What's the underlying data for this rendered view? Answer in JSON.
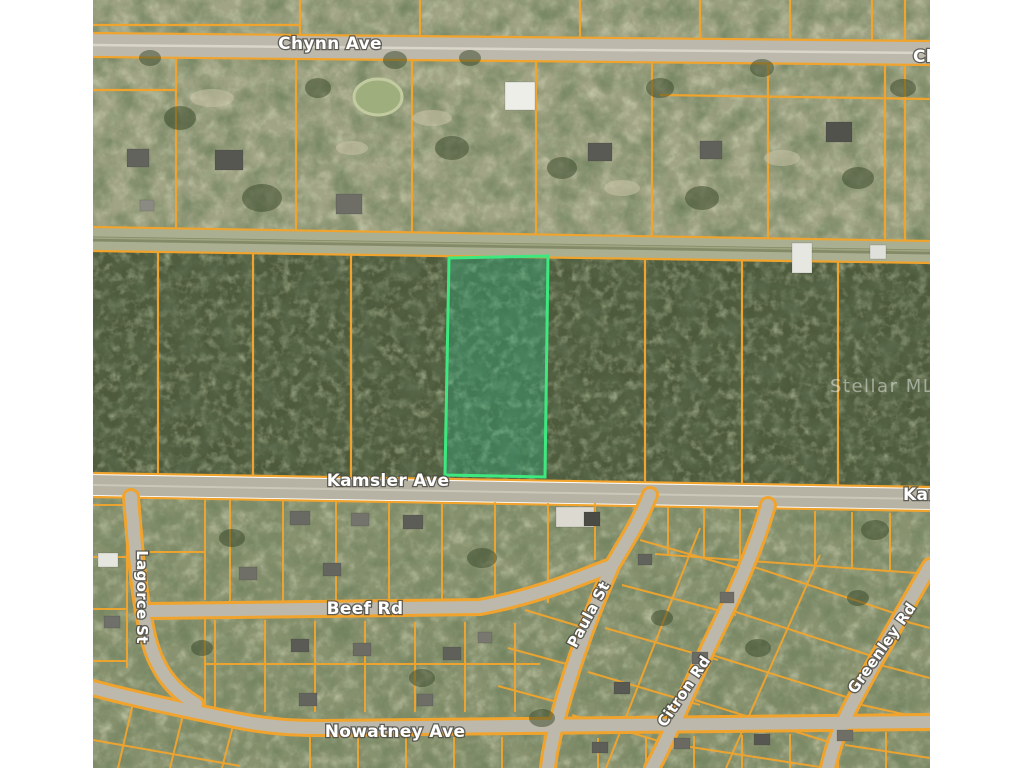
{
  "page": {
    "kind": "aerial-parcel-map-listing-image",
    "background": "#FFFFFF"
  },
  "colors": {
    "parcel_line": "#F1A42D",
    "road_fill": "#BCB8AB",
    "grass_lots": "#A2A585",
    "alley": "#949B74",
    "forest": "#4E5A3C",
    "suburb": "#8A9370",
    "highlight_border": "#3DE97F",
    "highlight_fill": "rgba(45,190,140,0.32)",
    "watermark_color": "rgba(255,255,255,0.45)"
  },
  "labels": {
    "chynn_ave": "Chynn Ave",
    "chynn_ave_right_partial": "Chynn Ave",
    "kamsler_ave": "Kamsler Ave",
    "kamsler_ave_right_partial": "Kamsler Ave",
    "beef_rd": "Beef Rd",
    "nowatney_ave": "Nowatney Ave",
    "lagorce_st": "Lagorce St",
    "paula_st": "Paula St",
    "citron_rd": "Citron Rd",
    "greenley_rd": "Greenley Rd",
    "watermark": "Stellar MLS"
  },
  "map": {
    "horizontal_streets": [
      "Chynn Ave",
      "Kamsler Ave",
      "Beef Rd",
      "Nowatney Ave"
    ],
    "other_streets": [
      "Lagorce St",
      "Paula St",
      "Citron Rd",
      "Greenley Rd"
    ],
    "highlighted_parcel": {
      "border_color": "#3DE97F",
      "location": "wooded lot on north side of Kamsler Ave"
    },
    "watermark": "Stellar MLS"
  }
}
